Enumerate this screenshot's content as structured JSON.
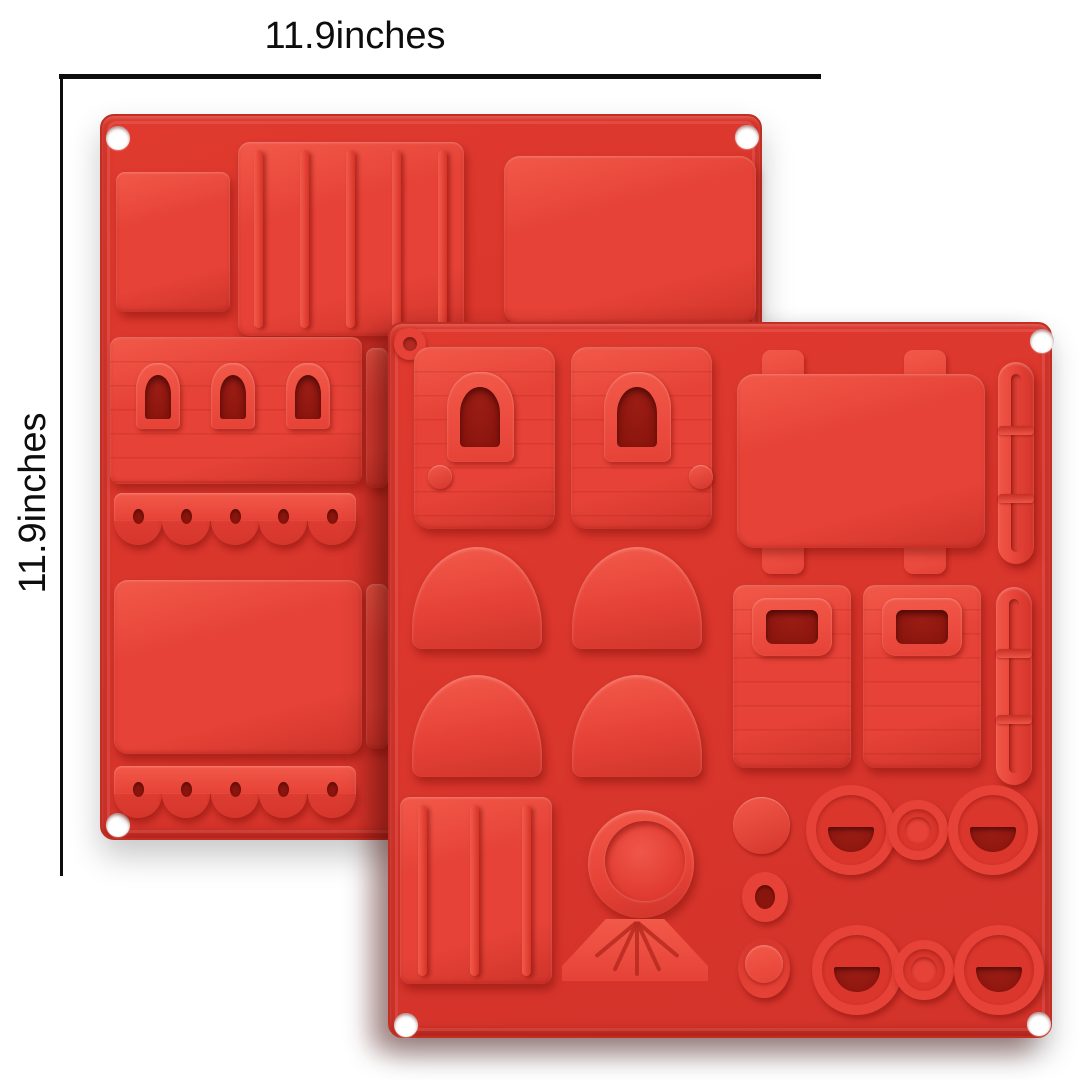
{
  "annotations": {
    "width_label": "11.9inches",
    "height_label": "11.9inches"
  },
  "colors": {
    "background": "#ffffff",
    "mold_red": "#da362c",
    "mold_red_raised": "#e64237",
    "mold_red_highlight": "#f25949",
    "mold_red_deep": "#8a150d",
    "mold_red_dark": "#b72a20",
    "annotation_ink": "#0d0d0d"
  },
  "scene": {
    "description": "Two overlapping square red silicone train-themed baking mold trays on a white background, annotated with width and height dimension lines",
    "back_tray": {
      "corner_holes_visible": 3,
      "cavities": [
        "square block",
        "ribbed roof panel",
        "plain rectangle",
        "carriage with three arched windows",
        "five-wheel scalloped strip",
        "large plain rectangle",
        "five-wheel scalloped strip"
      ]
    },
    "front_tray": {
      "corner_holes_visible": 4,
      "cavities": [
        "cab front with arched window (x2)",
        "chassis plate with four corner tabs",
        "segmented coupling rod (x2)",
        "dome (x4)",
        "wagon side with window (x2)",
        "ribbed roof panel",
        "boiler front disc",
        "cowcatcher fan",
        "small disc",
        "ring",
        "cylinder",
        "triple-wheel set (x2)"
      ]
    }
  }
}
